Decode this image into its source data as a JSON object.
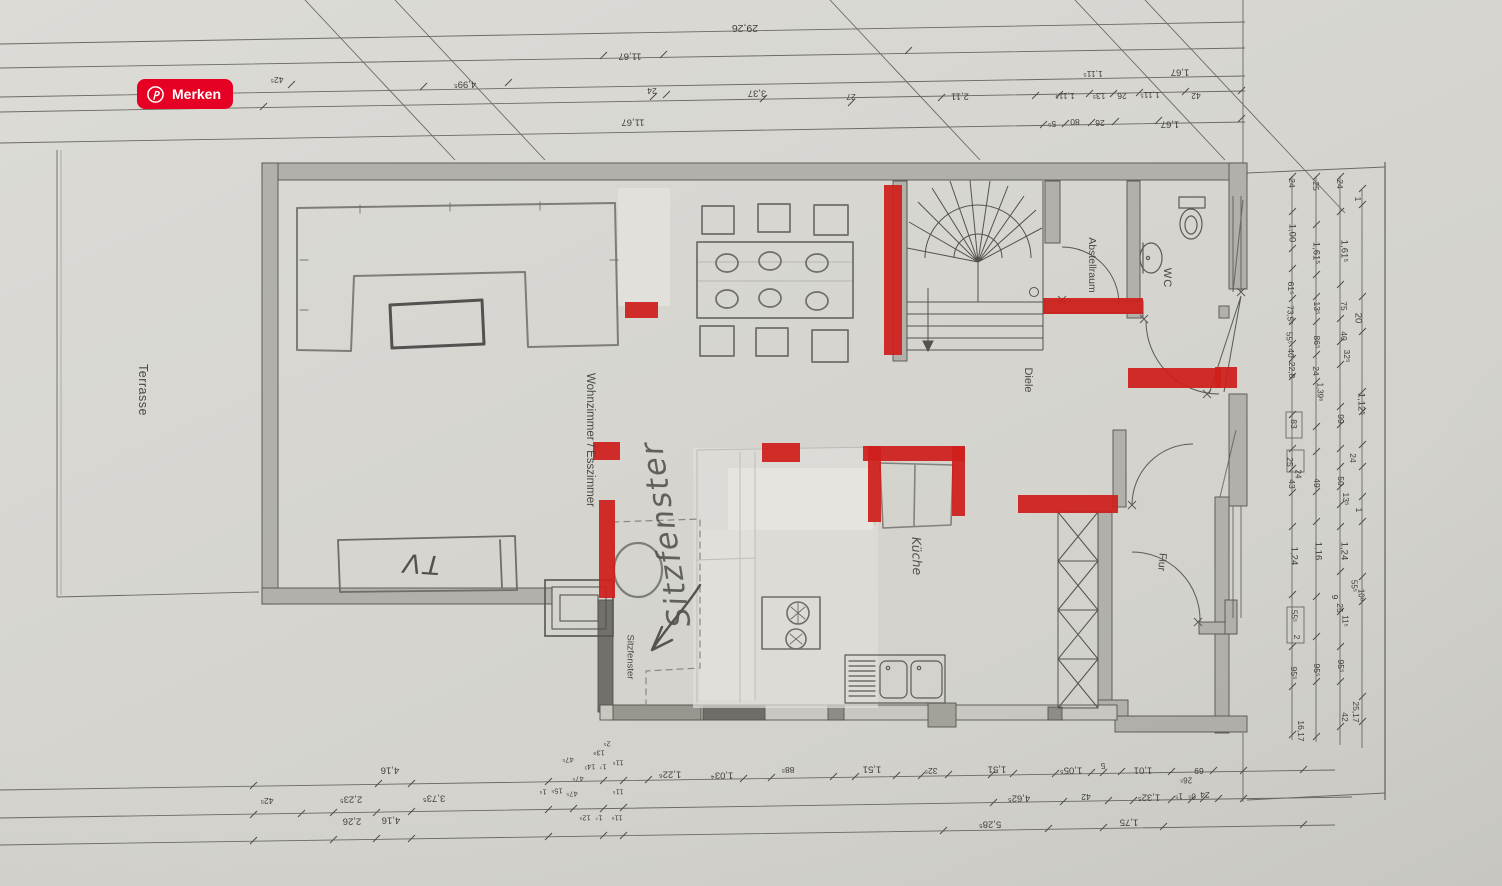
{
  "save_button": {
    "label": "Merken",
    "color": "#e60023",
    "icon": "pinterest-icon"
  },
  "floor_plan": {
    "rooms": {
      "terrasse": "Terrasse",
      "wohnzimmer_esszimmer": "Wohnzimmer / Esszimmer",
      "diele": "Diele",
      "kueche": "Küche",
      "abstellraum": "Abstellraum",
      "wc": "WC",
      "flur": "Flur",
      "sitzfenster_window": "Sitzfenster"
    },
    "handwritten": {
      "tv": "TV",
      "sitzfenster": "Sitzfenster"
    },
    "annotations": {
      "red_color": "#cf1f1c",
      "red_marks": [
        {
          "x": 884,
          "y": 185,
          "w": 18,
          "h": 170
        },
        {
          "x": 625,
          "y": 302,
          "w": 33,
          "h": 16
        },
        {
          "x": 593,
          "y": 442,
          "w": 27,
          "h": 18
        },
        {
          "x": 599,
          "y": 500,
          "w": 16,
          "h": 98
        },
        {
          "x": 762,
          "y": 443,
          "w": 38,
          "h": 19
        },
        {
          "x": 863,
          "y": 446,
          "w": 102,
          "h": 15
        },
        {
          "x": 868,
          "y": 446,
          "w": 13,
          "h": 76
        },
        {
          "x": 952,
          "y": 446,
          "w": 13,
          "h": 70
        },
        {
          "x": 1043,
          "y": 298,
          "w": 100,
          "h": 16
        },
        {
          "x": 1018,
          "y": 495,
          "w": 100,
          "h": 18
        },
        {
          "x": 1128,
          "y": 368,
          "w": 93,
          "h": 20
        },
        {
          "x": 1215,
          "y": 367,
          "w": 22,
          "h": 21
        }
      ]
    },
    "dimension_labels": [
      {
        "t": "29,26",
        "x": 745,
        "y": 28,
        "r": 180,
        "s": 10.5
      },
      {
        "t": "11,67",
        "x": 630,
        "y": 56,
        "r": 180
      },
      {
        "t": "24",
        "x": 652,
        "y": 91,
        "r": 180,
        "s": 8.5
      },
      {
        "t": "3,37",
        "x": 757,
        "y": 93,
        "r": 180
      },
      {
        "t": "11,67",
        "x": 633,
        "y": 122,
        "r": 180
      },
      {
        "t": "4,99⁵",
        "x": 465,
        "y": 84,
        "r": 180
      },
      {
        "t": "42⁵",
        "x": 277,
        "y": 80,
        "r": 180,
        "s": 8.5
      },
      {
        "t": "27",
        "x": 851,
        "y": 97,
        "r": 180,
        "s": 8.5
      },
      {
        "t": "2,11",
        "x": 960,
        "y": 96,
        "r": 180
      },
      {
        "t": "1,11⁵",
        "x": 1065,
        "y": 96,
        "r": 180,
        "s": 8.5
      },
      {
        "t": "13⁵",
        "x": 1099,
        "y": 96,
        "r": 180,
        "s": 8.5
      },
      {
        "t": "26",
        "x": 1122,
        "y": 96,
        "r": 180,
        "s": 8.5
      },
      {
        "t": "1,11⁵",
        "x": 1150,
        "y": 95,
        "r": 180,
        "s": 8.5
      },
      {
        "t": "42",
        "x": 1196,
        "y": 96,
        "r": 180,
        "s": 8.5
      },
      {
        "t": "1,11⁵",
        "x": 1093,
        "y": 74,
        "r": 180,
        "s": 8.5
      },
      {
        "t": "1,67",
        "x": 1180,
        "y": 72,
        "r": 180
      },
      {
        "t": "5⁵",
        "x": 1052,
        "y": 124,
        "r": 180,
        "s": 8.5
      },
      {
        "t": "80",
        "x": 1075,
        "y": 122,
        "r": 180,
        "s": 8.5
      },
      {
        "t": "26",
        "x": 1100,
        "y": 123,
        "r": 180,
        "s": 8.5
      },
      {
        "t": "1,67",
        "x": 1170,
        "y": 124,
        "r": 180
      },
      {
        "t": "4,16",
        "x": 390,
        "y": 770,
        "r": 180
      },
      {
        "t": "1,22⁶",
        "x": 670,
        "y": 774,
        "r": 180
      },
      {
        "t": "1,03⁴",
        "x": 722,
        "y": 775,
        "r": 180
      },
      {
        "t": "88⁵",
        "x": 788,
        "y": 770,
        "r": 180,
        "s": 8.5
      },
      {
        "t": "1,51",
        "x": 872,
        "y": 769,
        "r": 180
      },
      {
        "t": "32⁵",
        "x": 931,
        "y": 771,
        "r": 180,
        "s": 8.5
      },
      {
        "t": "1,51",
        "x": 997,
        "y": 769,
        "r": 180
      },
      {
        "t": "1,05⁵",
        "x": 1071,
        "y": 770,
        "r": 180
      },
      {
        "t": "5",
        "x": 1103,
        "y": 766,
        "r": 180,
        "s": 8.5
      },
      {
        "t": "1,01",
        "x": 1143,
        "y": 770,
        "r": 180
      },
      {
        "t": "26⁵",
        "x": 1186,
        "y": 780,
        "r": 180,
        "s": 8
      },
      {
        "t": "69",
        "x": 1199,
        "y": 771,
        "r": 180,
        "s": 8.5
      },
      {
        "t": "42⁵",
        "x": 267,
        "y": 801,
        "r": 180,
        "s": 8.5
      },
      {
        "t": "2,23⁵",
        "x": 351,
        "y": 799,
        "r": 180
      },
      {
        "t": "3,73⁵",
        "x": 434,
        "y": 798,
        "r": 180
      },
      {
        "t": "4,62⁵",
        "x": 1019,
        "y": 798,
        "r": 180
      },
      {
        "t": "42",
        "x": 1086,
        "y": 797,
        "r": 180,
        "s": 8.5
      },
      {
        "t": "1,32⁵",
        "x": 1149,
        "y": 797,
        "r": 180
      },
      {
        "t": "1⁵",
        "x": 1179,
        "y": 796,
        "r": 180,
        "s": 8
      },
      {
        "t": "0⁵",
        "x": 1192,
        "y": 796,
        "r": 180,
        "s": 8
      },
      {
        "t": "24",
        "x": 1205,
        "y": 795,
        "r": 180,
        "s": 8.5
      },
      {
        "t": "2,26",
        "x": 352,
        "y": 821,
        "r": 180
      },
      {
        "t": "4,16",
        "x": 391,
        "y": 820,
        "r": 180
      },
      {
        "t": "5,28⁵",
        "x": 990,
        "y": 824,
        "r": 180
      },
      {
        "t": "1,75",
        "x": 1129,
        "y": 822,
        "r": 180
      },
      {
        "t": "2⁵",
        "x": 607,
        "y": 744,
        "r": 180,
        "s": 7.5
      },
      {
        "t": "13⁸",
        "x": 599,
        "y": 753,
        "r": 180,
        "s": 7.5
      },
      {
        "t": "47⁵",
        "x": 568,
        "y": 760,
        "r": 180,
        "s": 7.5
      },
      {
        "t": "14¹",
        "x": 590,
        "y": 767,
        "r": 180,
        "s": 7.5
      },
      {
        "t": "1⁷",
        "x": 603,
        "y": 767,
        "r": 180,
        "s": 7.5
      },
      {
        "t": "11⁵",
        "x": 618,
        "y": 763,
        "r": 180,
        "s": 7.5
      },
      {
        "t": "47⁵",
        "x": 578,
        "y": 779,
        "r": 180,
        "s": 7.5
      },
      {
        "t": "1⁵",
        "x": 543,
        "y": 792,
        "r": 180,
        "s": 7.5
      },
      {
        "t": "15⁵",
        "x": 557,
        "y": 791,
        "r": 180,
        "s": 7.5
      },
      {
        "t": "47⁵",
        "x": 572,
        "y": 794,
        "r": 180,
        "s": 7.5
      },
      {
        "t": "11⁵",
        "x": 618,
        "y": 792,
        "r": 180,
        "s": 7.5
      },
      {
        "t": "12⁵",
        "x": 585,
        "y": 818,
        "r": 180,
        "s": 7.5
      },
      {
        "t": "1⁷",
        "x": 599,
        "y": 818,
        "r": 180,
        "s": 7.5
      },
      {
        "t": "11⁵",
        "x": 617,
        "y": 818,
        "r": 180,
        "s": 7.5
      },
      {
        "t": "24",
        "x": 1292,
        "y": 183,
        "r": 90,
        "s": 8.5
      },
      {
        "t": "25",
        "x": 1316,
        "y": 186,
        "r": 90,
        "s": 8.5
      },
      {
        "t": "24",
        "x": 1340,
        "y": 184,
        "r": 90,
        "s": 8.5
      },
      {
        "t": "1",
        "x": 1358,
        "y": 199,
        "r": 90,
        "s": 8.5
      },
      {
        "t": "1,00",
        "x": 1292,
        "y": 233,
        "r": 90
      },
      {
        "t": "1,61⁵",
        "x": 1316,
        "y": 253,
        "r": 90
      },
      {
        "t": "1,61⁵",
        "x": 1344,
        "y": 251,
        "r": 90
      },
      {
        "t": "61⁵",
        "x": 1291,
        "y": 288,
        "r": 90,
        "s": 8.5
      },
      {
        "t": "73,5⁵",
        "x": 1290,
        "y": 315,
        "r": 90,
        "s": 8
      },
      {
        "t": "55⁵",
        "x": 1289,
        "y": 338,
        "r": 90,
        "s": 8
      },
      {
        "t": "40",
        "x": 1291,
        "y": 353,
        "r": 90,
        "s": 8.5
      },
      {
        "t": "22,8",
        "x": 1292,
        "y": 370,
        "r": 90,
        "s": 8.5
      },
      {
        "t": "13⁵",
        "x": 1317,
        "y": 308,
        "r": 90,
        "s": 8.5
      },
      {
        "t": "86⁵",
        "x": 1317,
        "y": 342,
        "r": 90,
        "s": 8.5
      },
      {
        "t": "24",
        "x": 1316,
        "y": 371,
        "r": 90,
        "s": 8.5
      },
      {
        "t": "1,39⁶",
        "x": 1320,
        "y": 392,
        "r": 90,
        "s": 8
      },
      {
        "t": "75",
        "x": 1344,
        "y": 306,
        "r": 90,
        "s": 8.5
      },
      {
        "t": "40",
        "x": 1344,
        "y": 336,
        "r": 90,
        "s": 8.5
      },
      {
        "t": "32⁵",
        "x": 1347,
        "y": 356,
        "r": 90,
        "s": 8.5
      },
      {
        "t": "20",
        "x": 1358,
        "y": 318,
        "r": 90
      },
      {
        "t": "1,12⁵",
        "x": 1361,
        "y": 404,
        "r": 90
      },
      {
        "t": "99",
        "x": 1341,
        "y": 419,
        "r": 90,
        "s": 8.5
      },
      {
        "t": "83",
        "x": 1294,
        "y": 424,
        "r": 90,
        "s": 8.5
      },
      {
        "t": "24",
        "x": 1353,
        "y": 458,
        "r": 90,
        "s": 8.5
      },
      {
        "t": "25",
        "x": 1290,
        "y": 462,
        "r": 90,
        "s": 8.5
      },
      {
        "t": "24",
        "x": 1298,
        "y": 474,
        "r": 90,
        "s": 8
      },
      {
        "t": "50",
        "x": 1341,
        "y": 481,
        "r": 90,
        "s": 8.5
      },
      {
        "t": "49",
        "x": 1317,
        "y": 483,
        "r": 90,
        "s": 8.5
      },
      {
        "t": "43",
        "x": 1292,
        "y": 484,
        "r": 90,
        "s": 8.5
      },
      {
        "t": "13⁵",
        "x": 1346,
        "y": 499,
        "r": 90,
        "s": 8.5
      },
      {
        "t": "1",
        "x": 1359,
        "y": 510,
        "r": 90,
        "s": 8.5
      },
      {
        "t": "1,24",
        "x": 1344,
        "y": 551,
        "r": 90
      },
      {
        "t": "1,16",
        "x": 1318,
        "y": 551,
        "r": 90
      },
      {
        "t": "1,24",
        "x": 1294,
        "y": 556,
        "r": 90
      },
      {
        "t": "55⁵",
        "x": 1354,
        "y": 586,
        "r": 90,
        "s": 8
      },
      {
        "t": "10⁸",
        "x": 1361,
        "y": 595,
        "r": 90,
        "s": 8
      },
      {
        "t": "9",
        "x": 1335,
        "y": 597,
        "r": 90,
        "s": 8.5
      },
      {
        "t": "25",
        "x": 1340,
        "y": 608,
        "r": 90,
        "s": 8.5
      },
      {
        "t": "11⁵",
        "x": 1345,
        "y": 621,
        "r": 90,
        "s": 8
      },
      {
        "t": "55⁵",
        "x": 1294,
        "y": 616,
        "r": 90,
        "s": 8
      },
      {
        "t": "2",
        "x": 1297,
        "y": 637,
        "r": 90,
        "s": 8.5
      },
      {
        "t": "95⁵",
        "x": 1341,
        "y": 666,
        "r": 90,
        "s": 8.5
      },
      {
        "t": "95⁵",
        "x": 1317,
        "y": 670,
        "r": 90,
        "s": 8.5
      },
      {
        "t": "95⁵",
        "x": 1294,
        "y": 673,
        "r": 90,
        "s": 8.5
      },
      {
        "t": "25,17",
        "x": 1356,
        "y": 712,
        "r": 90,
        "s": 8.5
      },
      {
        "t": "42",
        "x": 1345,
        "y": 717,
        "r": 90,
        "s": 8.5
      },
      {
        "t": "16,17",
        "x": 1301,
        "y": 731,
        "r": 90,
        "s": 8.5
      }
    ]
  }
}
